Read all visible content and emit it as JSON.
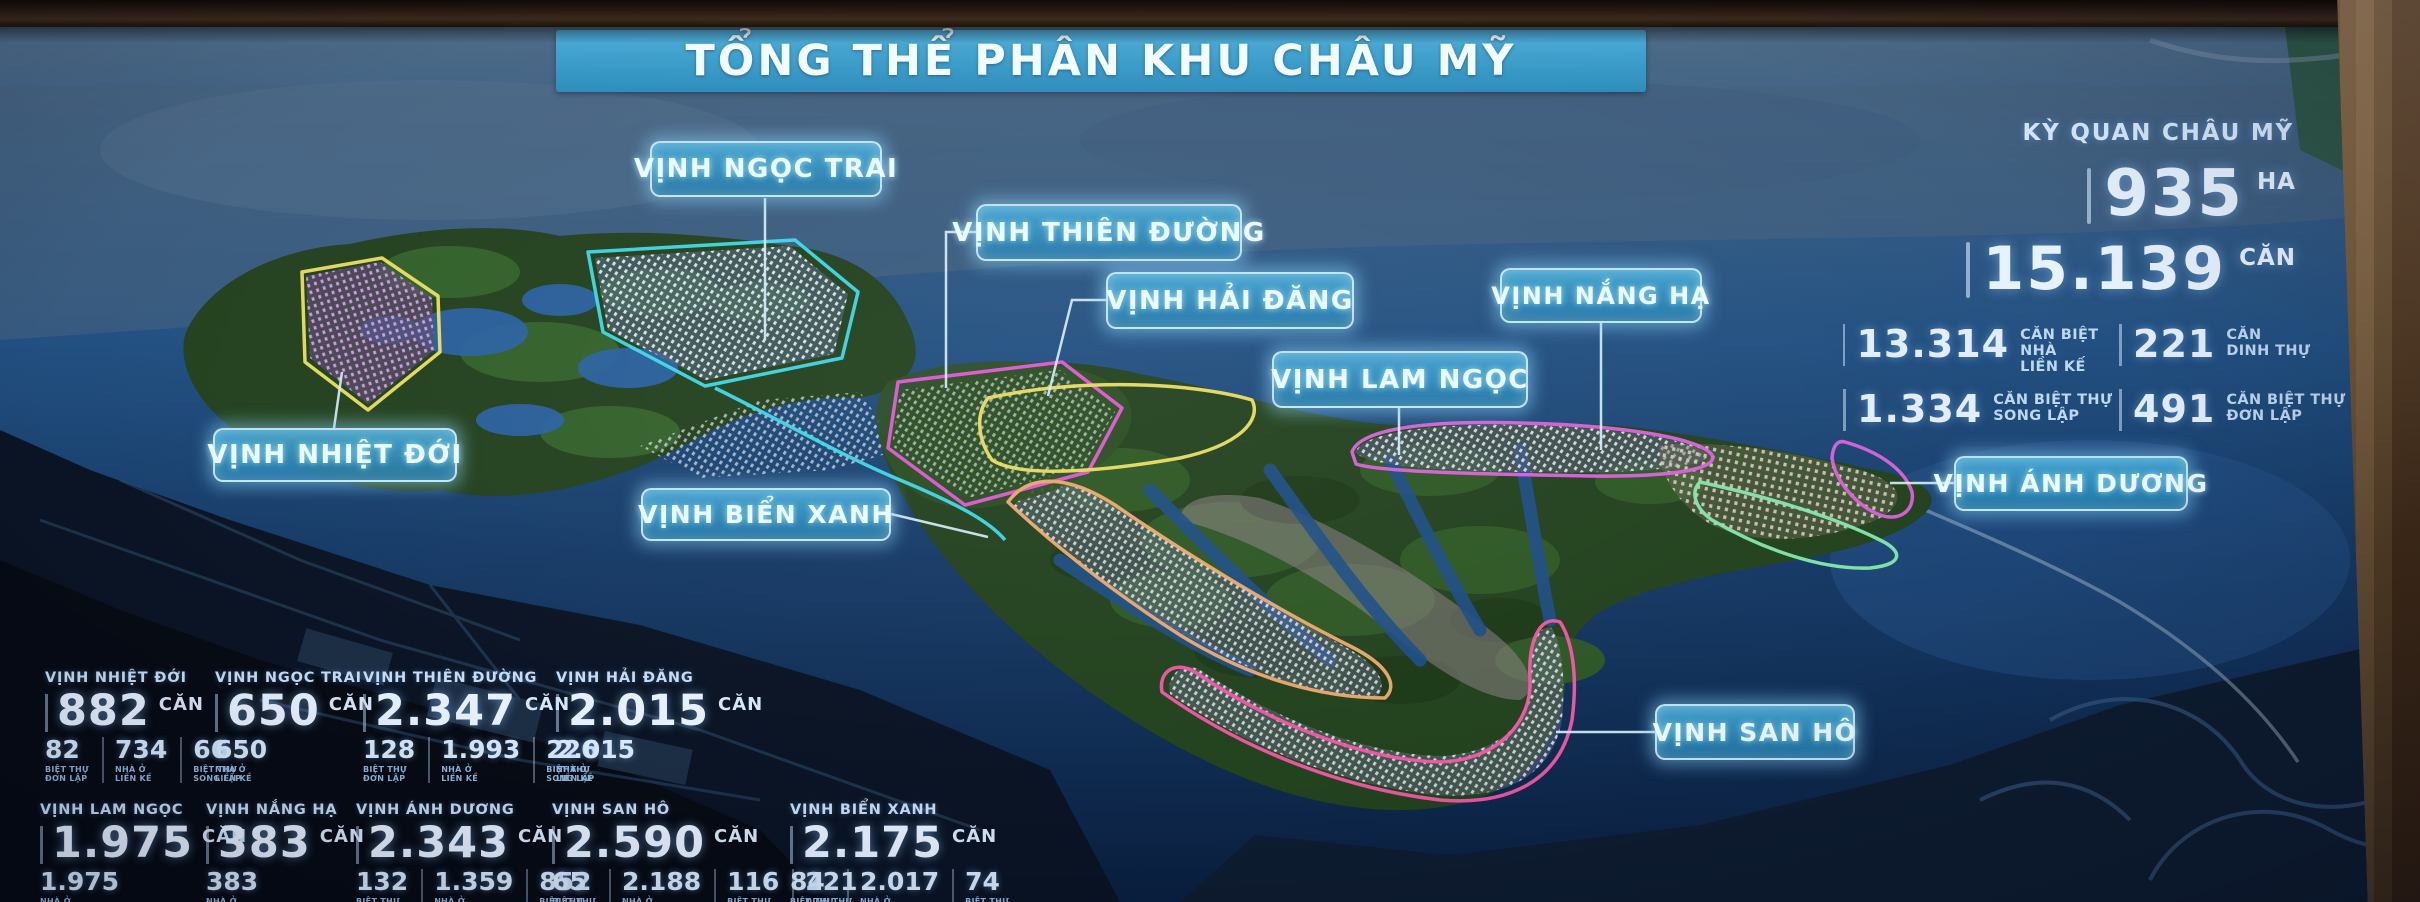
{
  "title": "TỔNG THỂ PHÂN KHU CHÂU MỸ",
  "summary": {
    "heading": "KỲ QUAN CHÂU MỸ",
    "area_value": "935",
    "area_unit": "HA",
    "total_value": "15.139",
    "total_unit": "CĂN",
    "breakdown": [
      {
        "value": "13.314",
        "label": "CĂN BIỆT NHÀ\nLIỀN KẾ"
      },
      {
        "value": "221",
        "label": "CĂN\nDINH THỰ"
      },
      {
        "value": "1.334",
        "label": "CĂN BIỆT THỰ\nSONG LẬP"
      },
      {
        "value": "491",
        "label": "CĂN BIỆT THỰ\nĐƠN LẬP"
      }
    ]
  },
  "callouts": [
    {
      "id": "vinh-ngoc-trai",
      "label": "VỊNH NGỌC TRAI"
    },
    {
      "id": "vinh-thien-duong",
      "label": "VỊNH THIÊN ĐƯỜNG"
    },
    {
      "id": "vinh-hai-dang",
      "label": "VỊNH HẢI ĐĂNG"
    },
    {
      "id": "vinh-nang-ha",
      "label": "VỊNH NẮNG HẠ"
    },
    {
      "id": "vinh-lam-ngoc",
      "label": "VỊNH LAM NGỌC"
    },
    {
      "id": "vinh-nhiet-doi",
      "label": "VỊNH NHIỆT ĐỚI"
    },
    {
      "id": "vinh-bien-xanh",
      "label": "VỊNH BIỂN XANH"
    },
    {
      "id": "vinh-anh-duong",
      "label": "VỊNH ÁNH DƯƠNG"
    },
    {
      "id": "vinh-san-ho",
      "label": "VỊNH SAN HÔ"
    }
  ],
  "zones": [
    {
      "name": "VỊNH NHIỆT ĐỚI",
      "total": "882",
      "unit": "CĂN",
      "sub": [
        {
          "value": "82",
          "label": "BIỆT THỰ\nĐƠN LẬP"
        },
        {
          "value": "734",
          "label": "NHÀ Ở\nLIỀN KỀ"
        },
        {
          "value": "66",
          "label": "BIỆT THỰ\nSONG LẬP"
        }
      ]
    },
    {
      "name": "VỊNH NGỌC TRAI",
      "total": "650",
      "unit": "CĂN",
      "sub": [
        {
          "value": "650",
          "label": "NHÀ Ở\nLIỀN KỀ"
        }
      ]
    },
    {
      "name": "VỊNH THIÊN ĐƯỜNG",
      "total": "2.347",
      "unit": "CĂN",
      "sub": [
        {
          "value": "128",
          "label": "BIỆT THỰ\nĐƠN LẬP"
        },
        {
          "value": "1.993",
          "label": "NHÀ Ở\nLIỀN KỀ"
        },
        {
          "value": "226",
          "label": "BIỆT THỰ\nSONG LẬP"
        }
      ]
    },
    {
      "name": "VỊNH HẢI ĐĂNG",
      "total": "2.015",
      "unit": "CĂN",
      "sub": [
        {
          "value": "2.015",
          "label": "NHÀ Ở\nLIỀN KỀ"
        }
      ]
    },
    {
      "name": "VỊNH LAM NGỌC",
      "total": "1.975",
      "unit": "CĂN",
      "sub": [
        {
          "value": "1.975",
          "label": "NHÀ Ở\nLIỀN KỀ"
        }
      ]
    },
    {
      "name": "VỊNH NẮNG HẠ",
      "total": "383",
      "unit": "CĂN",
      "sub": [
        {
          "value": "383",
          "label": "NHÀ Ở\nLIỀN KỀ"
        }
      ]
    },
    {
      "name": "VỊNH ÁNH DƯƠNG",
      "total": "2.343",
      "unit": "CĂN",
      "sub": [
        {
          "value": "132",
          "label": "BIỆT THỰ\nĐƠN LẬP"
        },
        {
          "value": "1.359",
          "label": "NHÀ Ở\nLIỀN KỀ"
        },
        {
          "value": "852",
          "label": "BIỆT THỰ\nSONG LẬP"
        }
      ]
    },
    {
      "name": "VỊNH SAN HÔ",
      "total": "2.590",
      "unit": "CĂN",
      "sub": [
        {
          "value": "65",
          "label": "BIỆT THỰ\nĐƠN LẬP"
        },
        {
          "value": "2.188",
          "label": "NHÀ Ở\nLIỀN KỀ"
        },
        {
          "value": "116",
          "label": "BIỆT THỰ\nSONG LẬP"
        },
        {
          "value": "221",
          "label": "DINH THỰ"
        }
      ]
    },
    {
      "name": "VỊNH BIỂN XANH",
      "total": "2.175",
      "unit": "CĂN",
      "sub": [
        {
          "value": "84",
          "label": "BIỆT THỰ\nĐƠN LẬP"
        },
        {
          "value": "2.017",
          "label": "NHÀ Ở\nLIỀN KỀ"
        },
        {
          "value": "74",
          "label": "BIỆT THỰ\nSONG LẬP"
        }
      ]
    }
  ],
  "colors": {
    "banner_blue": "#3b9cc9",
    "callout_fill": "#2e8cc0",
    "outline_yellow": "#ecdf63",
    "outline_teal": "#3fd9e8",
    "outline_magenta": "#e35ad6",
    "outline_pink": "#f558a5",
    "outline_orange": "#f0ab6e",
    "outline_mint": "#86e8ab",
    "water_deep": "#12315a",
    "wood_frame": "#7c5c38"
  }
}
